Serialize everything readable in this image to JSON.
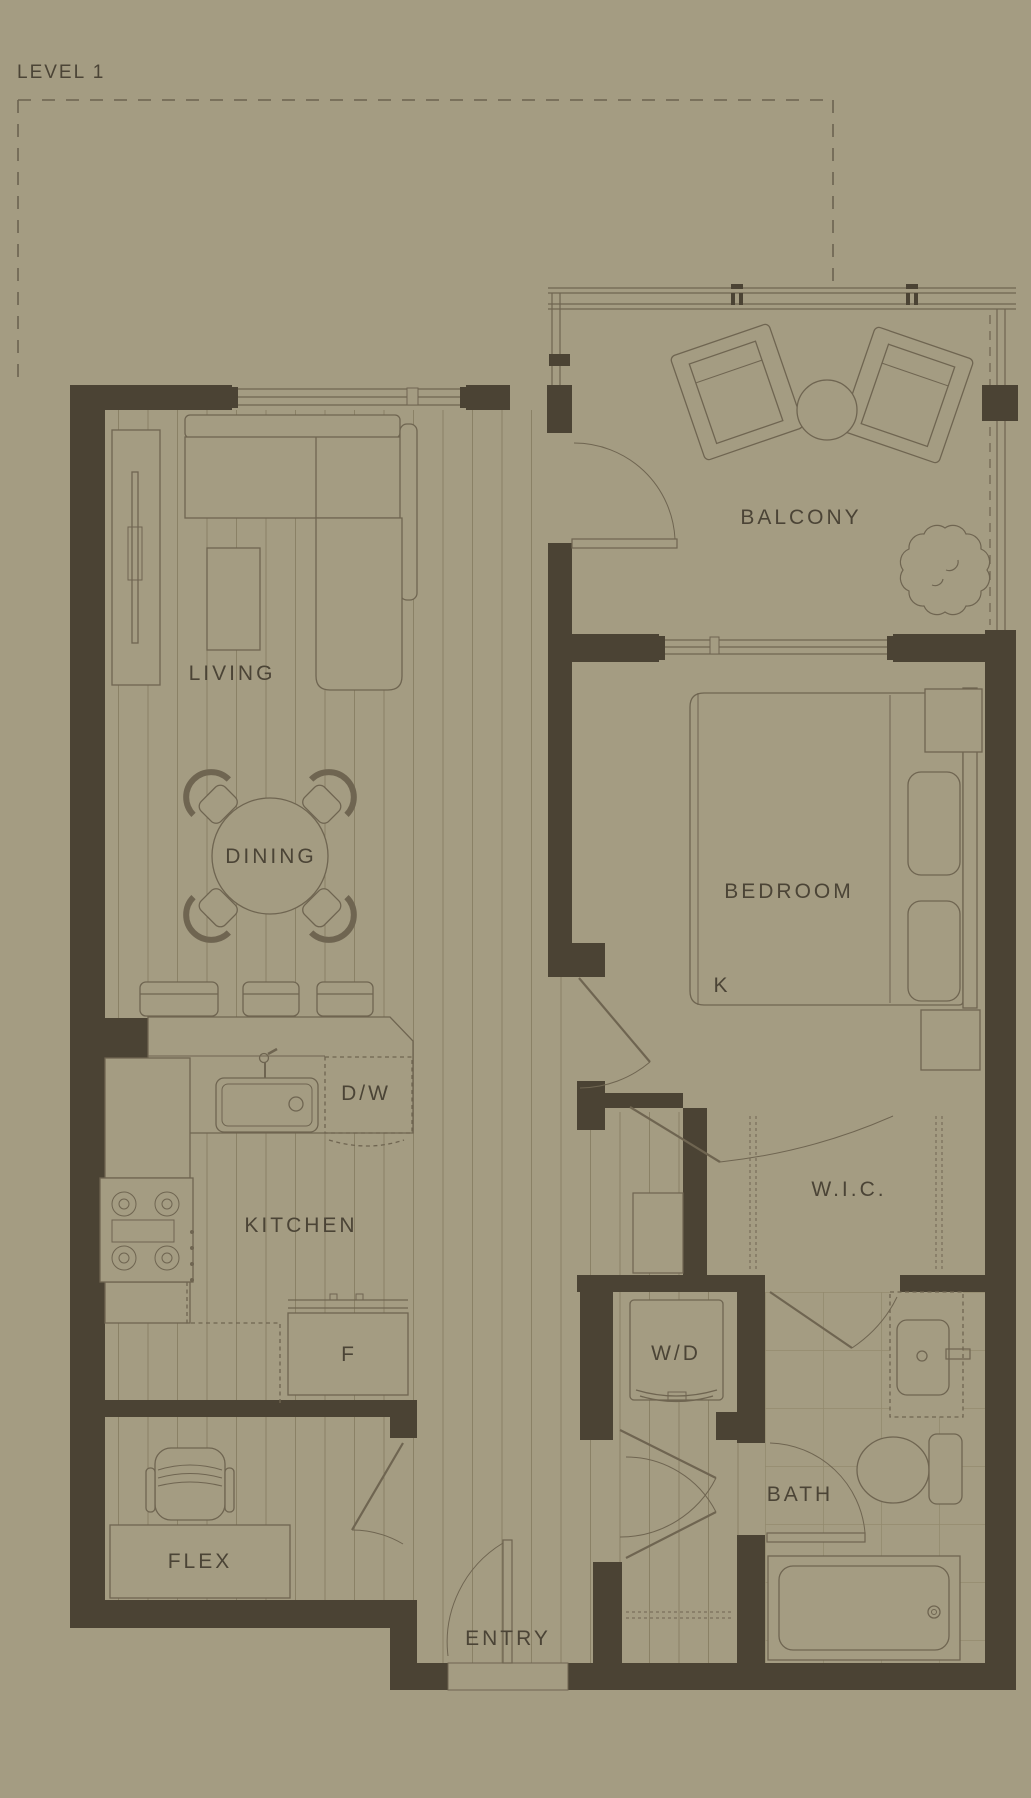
{
  "title": "LEVEL 1",
  "colors": {
    "background": "#a49c82",
    "wall": "#4b4334",
    "line": "#6f6551",
    "plank_line": "#8a8166",
    "text": "#4b4436"
  },
  "rooms": {
    "balcony": "BALCONY",
    "living": "LIVING",
    "dining": "DINING",
    "kitchen": "KITCHEN",
    "bedroom": "BEDROOM",
    "wic": "W.I.C.",
    "laundry": "W/D",
    "bath": "BATH",
    "flex": "FLEX",
    "entry": "ENTRY"
  },
  "appliances": {
    "dishwasher": "D/W",
    "fridge": "F",
    "bed": "K"
  }
}
